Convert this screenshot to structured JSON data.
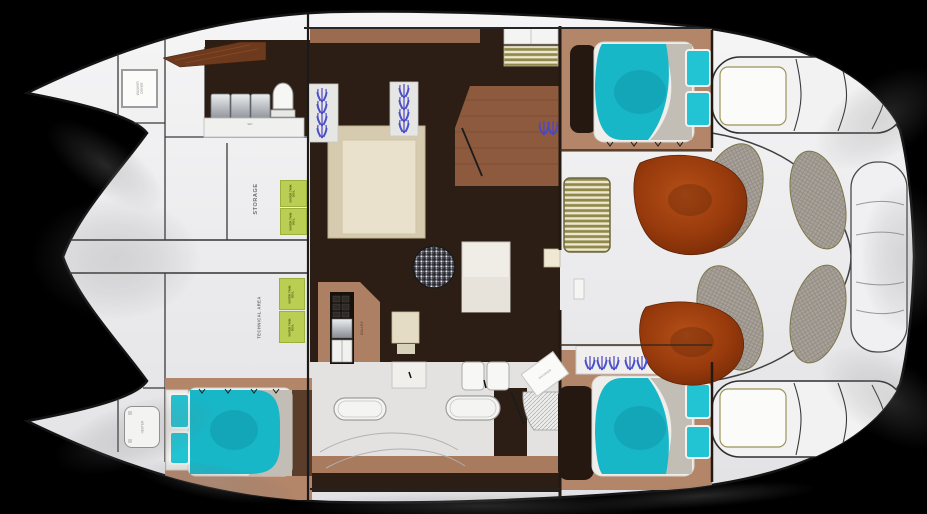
{
  "plan": {
    "type": "catamaran-interior-deck-plan",
    "labels": {
      "storage": "STORAGE",
      "technical_area": "TECHNICAL AREA",
      "water_tank_line1": "WATER TANK",
      "water_tank_line2": "300 L",
      "washer_line1": "WASHER",
      "washer_line2": "DRYER",
      "heater": "HEATER",
      "galley": "GALLEY",
      "shower": "SHOWER",
      "wc": "WC"
    },
    "colors": {
      "background": "#000000",
      "deck_white": "#ededef",
      "saloon_floor": "#2c1e14",
      "cabin_floor": "#b3866a",
      "galley_wood": "#8d5a3e",
      "bow_wood_wedge": "#6e3a1d",
      "bed_teal": "#18b7c8",
      "pillow_teal": "#22c3d3",
      "sofa_cream": "#d6cbae",
      "tank_green": "#b9ce52",
      "cockpit_cushion_rust": "#9a3c10",
      "sunpad_gray": "#a8a29a",
      "trim_olive": "#8a8450",
      "plant_purple": "#4f43c8"
    }
  }
}
